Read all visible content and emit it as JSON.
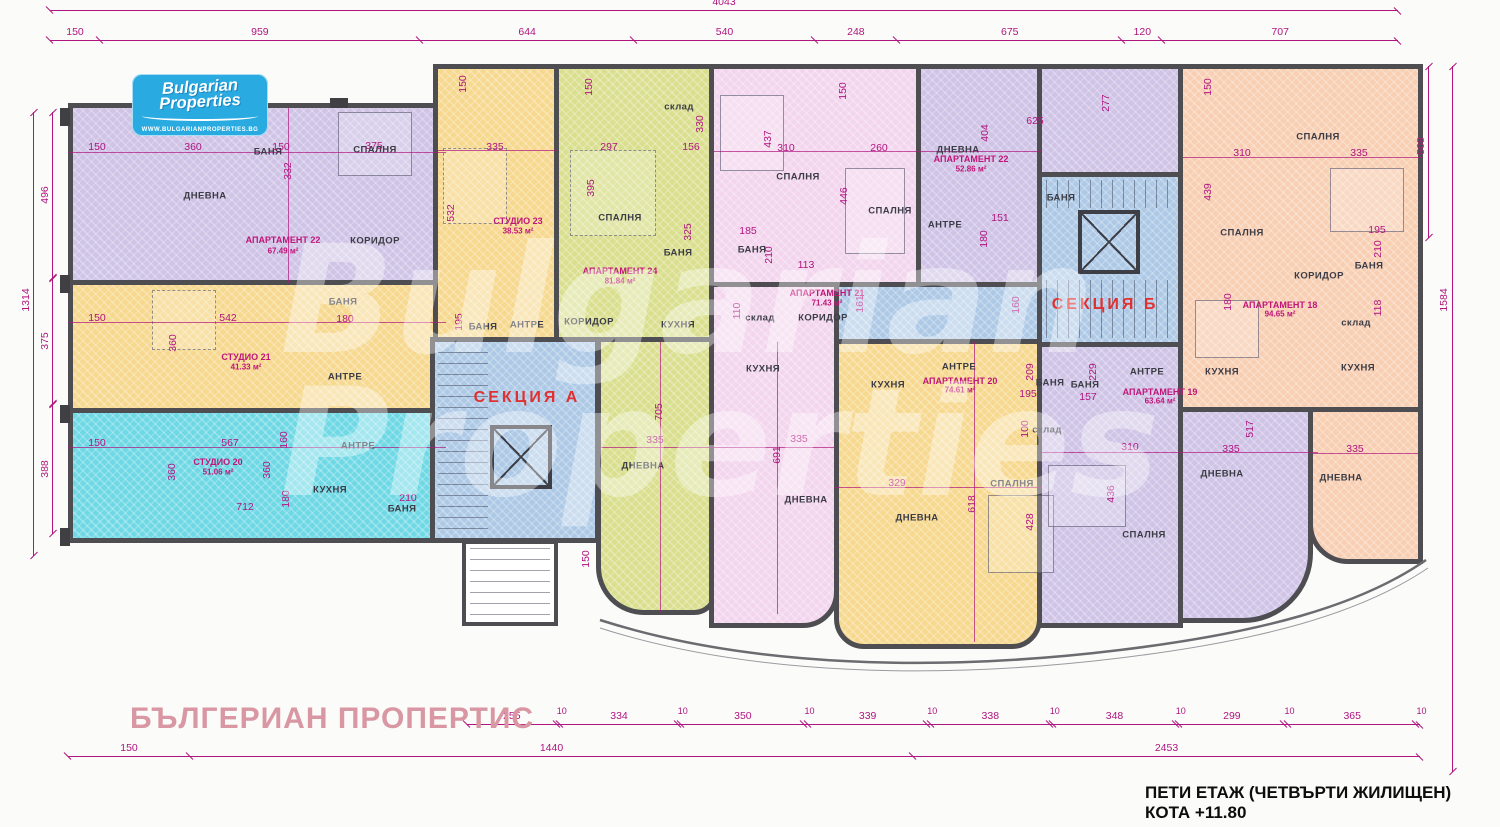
{
  "logo": {
    "brand_line1": "Bulgarian",
    "brand_line2": "Properties",
    "website": "WWW.BULGARIANPROPERTIES.BG"
  },
  "watermarks": {
    "pink_text": "БЪЛГЕРИАН ПРОПЕРТИС",
    "ghost_line1": "Bulgarian",
    "ghost_line2": "Properties"
  },
  "title_block": {
    "floor": "ПЕТИ ЕТАЖ   (ЧЕТВЪРТИ ЖИЛИЩЕН)",
    "elevation": "КОТА +11.80"
  },
  "sections": {
    "a": "СЕКЦИЯ А",
    "b": "СЕКЦИЯ Б"
  },
  "rooms": {
    "dnevna": "ДНЕВНА",
    "spalnya": "СПАЛНЯ",
    "banya": "БАНЯ",
    "koridor": "КОРИДОР",
    "antre": "АНТРЕ",
    "kuhnya": "КУХНЯ",
    "sklad": "склад"
  },
  "apartments": {
    "ap22_left": {
      "label": "АПАРТАМЕНТ 22",
      "area": "67.49 м²"
    },
    "studio21": {
      "label": "СТУДИО 21",
      "area": "41.33 м²"
    },
    "studio20": {
      "label": "СТУДИО 20",
      "area": "51.06 м²"
    },
    "studio23": {
      "label": "СТУДИО 23",
      "area": "38.53 м²"
    },
    "ap24": {
      "label": "АПАРТАМЕНТ 24",
      "area": "81.84 м²"
    },
    "ap21": {
      "label": "АПАРТАМЕНТ 21",
      "area": "71.43 м²"
    },
    "ap22_mid": {
      "label": "АПАРТАМЕНТ 22",
      "area": "52.86 м²"
    },
    "ap20": {
      "label": "АПАРТАМЕНТ 20",
      "area": "74.61 м²"
    },
    "ap19": {
      "label": "АПАРТАМЕНТ 19",
      "area": "63.64 м²"
    },
    "ap18": {
      "label": "АПАРТАМЕНТ 18",
      "area": "94.65 м²"
    }
  },
  "dimensions": {
    "top_total": "4043",
    "top_segments": [
      "150",
      "959",
      "644",
      "540",
      "248",
      "675",
      "120",
      "707"
    ],
    "left_total": "1314",
    "left_segments": [
      "496",
      "375",
      "388"
    ],
    "right_upper": "508",
    "right_total": "1584",
    "bottom_segments": [
      "255",
      "10",
      "334",
      "10",
      "350",
      "10",
      "339",
      "10",
      "338",
      "10",
      "348",
      "10",
      "299",
      "10",
      "365",
      "10"
    ],
    "bottom_row2": [
      "150",
      "1440",
      "2453"
    ]
  },
  "plan_dims": {
    "ap22l": [
      "150",
      "360",
      "150",
      "375",
      "332"
    ],
    "st21": [
      "150",
      "542",
      "180",
      "360"
    ],
    "st20": [
      "150",
      "567",
      "360",
      "360",
      "712",
      "180",
      "210",
      "160"
    ],
    "st23": [
      "150",
      "335",
      "532",
      "195"
    ],
    "ap24": [
      "150",
      "297",
      "156",
      "395",
      "330",
      "325",
      "705",
      "335",
      "150"
    ],
    "ap21": [
      "150",
      "437",
      "310",
      "260",
      "446",
      "185",
      "210",
      "113",
      "110",
      "161",
      "691",
      "335"
    ],
    "ap22m": [
      "404",
      "151",
      "180",
      "160",
      "625",
      "277"
    ],
    "ap20": [
      "209",
      "195",
      "100",
      "329",
      "618",
      "428"
    ],
    "ap19": [
      "229",
      "157",
      "310",
      "335",
      "436",
      "517"
    ],
    "ap18": [
      "150",
      "310",
      "335",
      "439",
      "195",
      "210",
      "118",
      "180",
      "335"
    ]
  },
  "palette": {
    "wall": "#4e4e52",
    "dim_magenta": "#b0157f",
    "section_red": "#e03030",
    "purple": "#cfc3e6",
    "yellow": "#f6d88f",
    "cyan": "#6fd8e5",
    "green": "#d9df8e",
    "pink": "#f3d6ee",
    "peach": "#f8cfb3",
    "stair_blue": "#adc9e6",
    "logo_blue": "#29abe2",
    "watermark_pink": "#d897a2"
  }
}
